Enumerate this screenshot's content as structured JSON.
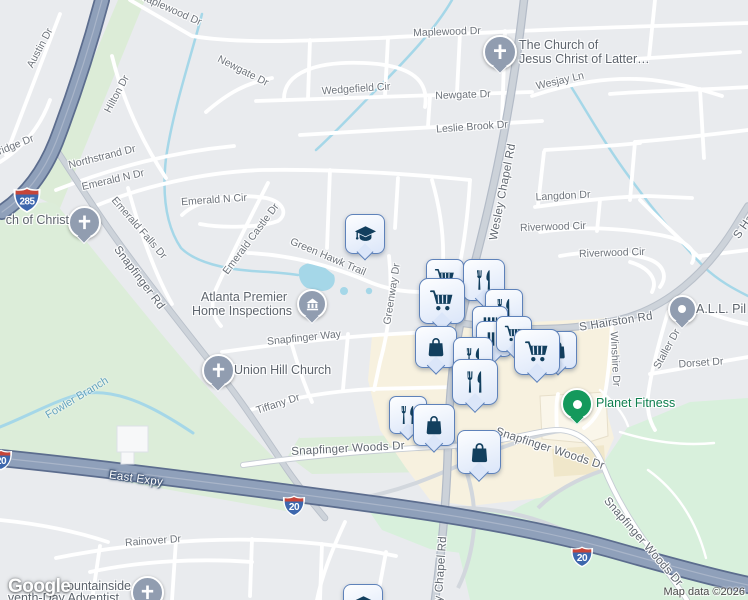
{
  "logo": {
    "text": "Google"
  },
  "attribution": {
    "map_data": "Map data ©2026"
  },
  "colors": {
    "park": "#dcedd9",
    "water": "#a5d7e8",
    "commercial": "#f7f1df",
    "highway": "#8fa0ba",
    "marker_icon": "#123f5e",
    "marker_border": "#5e82ba",
    "church_pin": "#919db0",
    "planet_fitness_pin": "#14995c",
    "planet_fitness_text": "#0e7e4e"
  },
  "street_labels": [
    {
      "t": "Maplewood Dr",
      "x": 170,
      "y": 9,
      "r": 24
    },
    {
      "t": "Maplewood Dr",
      "x": 447,
      "y": 32,
      "r": -2
    },
    {
      "t": "Newgate Dr",
      "x": 243,
      "y": 71,
      "r": 27
    },
    {
      "t": "Newgate Dr",
      "x": 463,
      "y": 95,
      "r": -2
    },
    {
      "t": "Wedgefield Cir",
      "x": 356,
      "y": 89,
      "r": -4
    },
    {
      "t": "Leslie Brook Dr",
      "x": 472,
      "y": 127,
      "r": -4
    },
    {
      "t": "Wesjay Ln",
      "x": 560,
      "y": 81,
      "r": -13
    },
    {
      "t": "Austin Dr",
      "x": 40,
      "y": 48,
      "r": -62
    },
    {
      "t": "Hilton Dr",
      "x": 117,
      "y": 94,
      "r": -62
    },
    {
      "t": "ridge Dr",
      "x": 16,
      "y": 145,
      "r": -22
    },
    {
      "t": "Northstrand Dr",
      "x": 102,
      "y": 157,
      "r": -14
    },
    {
      "t": "Emerald N Dr",
      "x": 113,
      "y": 180,
      "r": -13
    },
    {
      "t": "Emerald N Cir",
      "x": 214,
      "y": 200,
      "r": -4
    },
    {
      "t": "Emerald Falls Dr",
      "x": 139,
      "y": 228,
      "r": 49
    },
    {
      "t": "Emerald Castle Dr",
      "x": 251,
      "y": 239,
      "r": -53
    },
    {
      "t": "Snapfinger Rd",
      "x": 139,
      "y": 278,
      "r": 53,
      "c": "major"
    },
    {
      "t": "Green Hawk Trail",
      "x": 328,
      "y": 257,
      "r": 23
    },
    {
      "t": "Greenway Dr",
      "x": 392,
      "y": 294,
      "r": -81
    },
    {
      "t": "Snapfinger Way",
      "x": 304,
      "y": 338,
      "r": -6
    },
    {
      "t": "Tiffany Dr",
      "x": 278,
      "y": 404,
      "r": -18
    },
    {
      "t": "Snapfinger Woods Dr",
      "x": 348,
      "y": 449,
      "r": -3,
      "c": "major"
    },
    {
      "t": "Snapfinger Woods Dr",
      "x": 550,
      "y": 449,
      "r": 18,
      "c": "major"
    },
    {
      "t": "Snapfinger Woods Dr",
      "x": 643,
      "y": 542,
      "r": 49,
      "c": "major"
    },
    {
      "t": "S Hairston Rd",
      "x": 616,
      "y": 322,
      "r": -9,
      "c": "major"
    },
    {
      "t": "S Ha",
      "x": 744,
      "y": 227,
      "r": -55,
      "c": "major"
    },
    {
      "t": "Langdon Dr",
      "x": 563,
      "y": 196,
      "r": -3
    },
    {
      "t": "Riverwood Cir",
      "x": 553,
      "y": 227,
      "r": -2
    },
    {
      "t": "Riverwood Cir",
      "x": 612,
      "y": 253,
      "r": -2
    },
    {
      "t": "Winshire Dr",
      "x": 615,
      "y": 359,
      "r": 87
    },
    {
      "t": "Staller Dr",
      "x": 667,
      "y": 349,
      "r": -61
    },
    {
      "t": "Dorset Dr",
      "x": 701,
      "y": 363,
      "r": -4
    },
    {
      "t": "Rainover Dr",
      "x": 153,
      "y": 541,
      "r": -4
    },
    {
      "t": "East Expy",
      "x": 136,
      "y": 479,
      "r": 8,
      "c": "hwy"
    },
    {
      "t": "Wesley Chapel Rd",
      "x": 503,
      "y": 192,
      "r": -79,
      "c": "major"
    },
    {
      "t": "y Chapel Rd",
      "x": 441,
      "y": 569,
      "r": -86,
      "c": "major"
    }
  ],
  "water_labels": [
    {
      "t": "Fowler Branch",
      "x": 77,
      "y": 398,
      "r": -31
    }
  ],
  "places": [
    {
      "name": "the-church-of-jesus-christ",
      "icon": "church",
      "color": "gray",
      "ix": 498,
      "iy": 50,
      "is": 30,
      "labels": [
        {
          "t": "The Church of",
          "x": 519,
          "y": 45,
          "a": "l"
        },
        {
          "t": "Jesus Christ of Latter…",
          "x": 519,
          "y": 59,
          "a": "l"
        }
      ]
    },
    {
      "name": "church-of-christ",
      "icon": "church",
      "color": "gray",
      "ix": 82,
      "iy": 220,
      "is": 29,
      "labels": [
        {
          "t": "ch of Christ",
          "x": 69,
          "y": 220,
          "a": "r"
        }
      ]
    },
    {
      "name": "atlanta-premier-home-inspections",
      "icon": "home-inspection",
      "color": "gray",
      "ix": 310,
      "iy": 302,
      "is": 26,
      "labels": [
        {
          "t": "Atlanta Premier",
          "x": 244,
          "y": 297,
          "a": "c"
        },
        {
          "t": "Home Inspections",
          "x": 242,
          "y": 311,
          "a": "c"
        }
      ]
    },
    {
      "name": "union-hill-church",
      "icon": "church",
      "color": "gray",
      "ix": 216,
      "iy": 368,
      "is": 29,
      "labels": [
        {
          "t": "Union Hill Church",
          "x": 234,
          "y": 370,
          "a": "l"
        }
      ]
    },
    {
      "name": "planet-fitness",
      "icon": "dot-green",
      "color": "green",
      "ix": 575,
      "iy": 402,
      "is": 28,
      "labels": [
        {
          "t": "Planet Fitness",
          "x": 596,
          "y": 403,
          "a": "l"
        }
      ]
    },
    {
      "name": "all-pil",
      "icon": "dot-gray",
      "color": "gray",
      "ix": 680,
      "iy": 307,
      "is": 25,
      "labels": [
        {
          "t": "A.L.L. Pil",
          "x": 696,
          "y": 309,
          "a": "l"
        }
      ]
    },
    {
      "name": "mountainside-seventh-day-adventist",
      "icon": "church",
      "color": "gray",
      "ix": 145,
      "iy": 590,
      "is": 29,
      "labels": [
        {
          "t": "ountainside",
          "x": 131,
          "y": 586,
          "a": "r"
        },
        {
          "t": "venth-Day Adventist",
          "x": 119,
          "y": 598,
          "a": "r"
        }
      ]
    }
  ],
  "shields": [
    {
      "route": "285",
      "x": 27,
      "y": 200,
      "w": 30
    },
    {
      "route": "20",
      "x": 1,
      "y": 460,
      "w": 24
    },
    {
      "route": "20",
      "x": 294,
      "y": 506,
      "w": 24
    },
    {
      "route": "20",
      "x": 582,
      "y": 557,
      "w": 24
    }
  ],
  "markers": [
    {
      "icon": "shopping-cart",
      "x": 444,
      "y": 277,
      "s": 36
    },
    {
      "icon": "restaurant",
      "x": 483,
      "y": 279,
      "s": 40
    },
    {
      "icon": "shopping-cart",
      "x": 441,
      "y": 300,
      "s": 44
    },
    {
      "icon": "restaurant",
      "x": 503,
      "y": 307,
      "s": 36
    },
    {
      "icon": "bars",
      "x": 489,
      "y": 323,
      "s": 34
    },
    {
      "icon": "bars",
      "x": 493,
      "y": 338,
      "s": 34
    },
    {
      "icon": "shopping-cart",
      "x": 513,
      "y": 333,
      "s": 34
    },
    {
      "icon": "shopping-bag",
      "x": 557,
      "y": 349,
      "s": 36
    },
    {
      "icon": "shopping-cart",
      "x": 536,
      "y": 351,
      "s": 44
    },
    {
      "icon": "shopping-bag",
      "x": 435,
      "y": 346,
      "s": 40
    },
    {
      "icon": "restaurant",
      "x": 472,
      "y": 356,
      "s": 38
    },
    {
      "icon": "restaurant",
      "x": 474,
      "y": 381,
      "s": 44
    },
    {
      "icon": "restaurant",
      "x": 407,
      "y": 414,
      "s": 36
    },
    {
      "icon": "shopping-bag",
      "x": 433,
      "y": 424,
      "s": 40
    },
    {
      "icon": "shopping-bag",
      "x": 478,
      "y": 451,
      "s": 42
    },
    {
      "icon": "graduation-cap",
      "x": 362,
      "y": 603,
      "s": 38
    },
    {
      "icon": "graduation-cap",
      "x": 364,
      "y": 233,
      "s": 38
    }
  ]
}
